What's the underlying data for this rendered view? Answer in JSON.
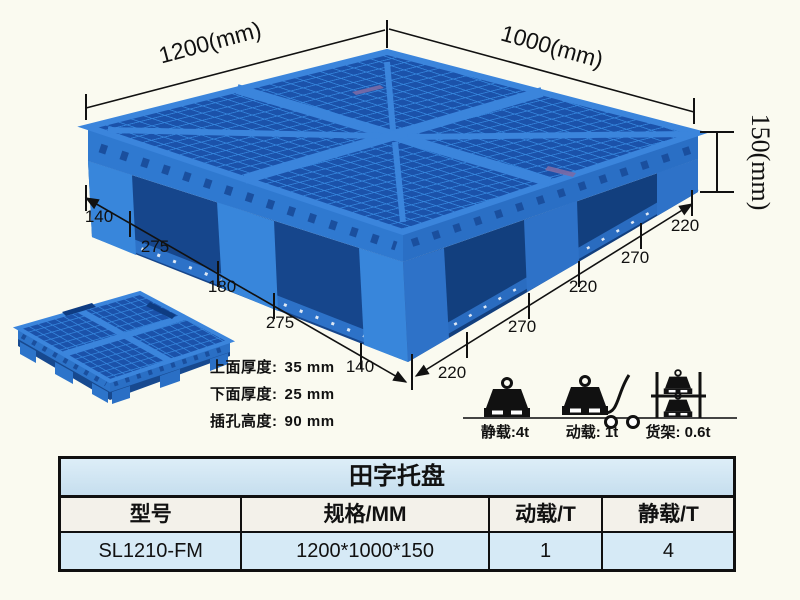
{
  "diagram": {
    "width_label": "1200(mm)",
    "depth_label": "1000(mm)",
    "height_label": "150(mm)",
    "left_edge_segments": [
      "140",
      "275",
      "180",
      "275",
      "140"
    ],
    "right_edge_segments": [
      "220",
      "270",
      "220",
      "270",
      "220"
    ],
    "specs": [
      {
        "label": "上面厚度:",
        "value": "35 mm"
      },
      {
        "label": "下面厚度:",
        "value": "25 mm"
      },
      {
        "label": "插孔高度:",
        "value": "90 mm"
      }
    ]
  },
  "load_ratings": [
    {
      "icon": "static-load-weight-icon",
      "caption": "静载:4t"
    },
    {
      "icon": "dynamic-load-trolley-icon",
      "caption": "动载: 1t"
    },
    {
      "icon": "rack-load-shelf-icon",
      "caption": "货架: 0.6t"
    }
  ],
  "table": {
    "title": "田字托盘",
    "headers": [
      "型号",
      "规格/MM",
      "动载/T",
      "静载/T"
    ],
    "rows": [
      [
        "SL1210-FM",
        "1200*1000*150",
        "1",
        "4"
      ]
    ]
  },
  "colors": {
    "pallet_blue": "#2f79d0",
    "pallet_dark_blue": "#1b52aa",
    "pallet_light_blue": "#3b85dc",
    "table_title_bg": "#cde4f2",
    "table_header_bg": "#f3f1ea",
    "table_data_bg": "#d6eaf6",
    "background": "#fafaf0"
  }
}
